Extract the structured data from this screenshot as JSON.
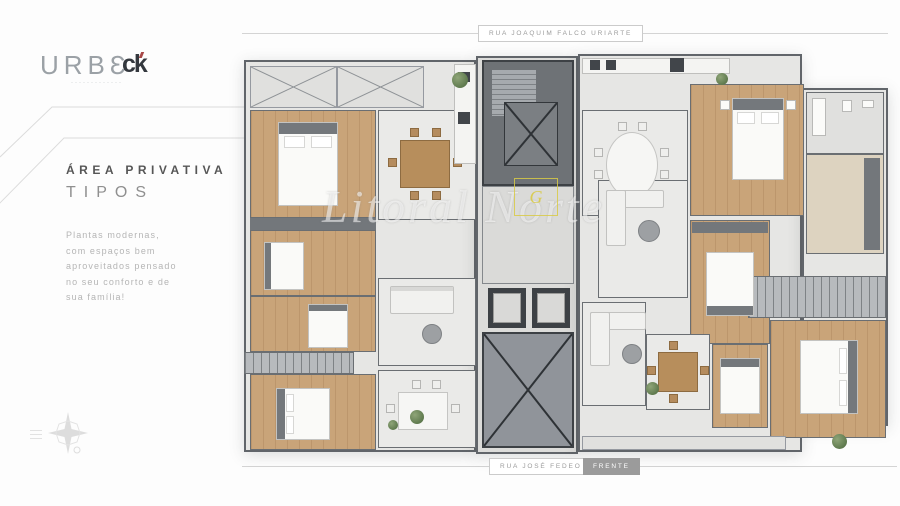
{
  "brand": {
    "wordmark": "URBƐ",
    "wordmark_sub": "·············",
    "partner_monogram": "ck"
  },
  "sidebar": {
    "title": "ÁREA PRIVATIVA",
    "subtitle": "TIPOS",
    "description_lines": [
      "Plantas modernas,",
      "com espaços bem",
      "aproveitados pensado",
      "no seu conforto e de",
      "sua família!"
    ]
  },
  "streets": {
    "top": "RUA JOAQUIM FALCO URIARTE",
    "bottom": "RUA JOSÉ FEDEO",
    "front_badge": "FRENTE"
  },
  "watermark": {
    "text": "Litoral Norte",
    "logo_letter": "G"
  },
  "colors": {
    "wood_floor": "#c9a479",
    "interior_floor": "#eaeae8",
    "balcony": "#b7babd",
    "walls": "#61656a",
    "core_dark": "#3d4145",
    "watermark_yellow": "#d8ca46",
    "badge_gray": "#9b9b9b"
  }
}
